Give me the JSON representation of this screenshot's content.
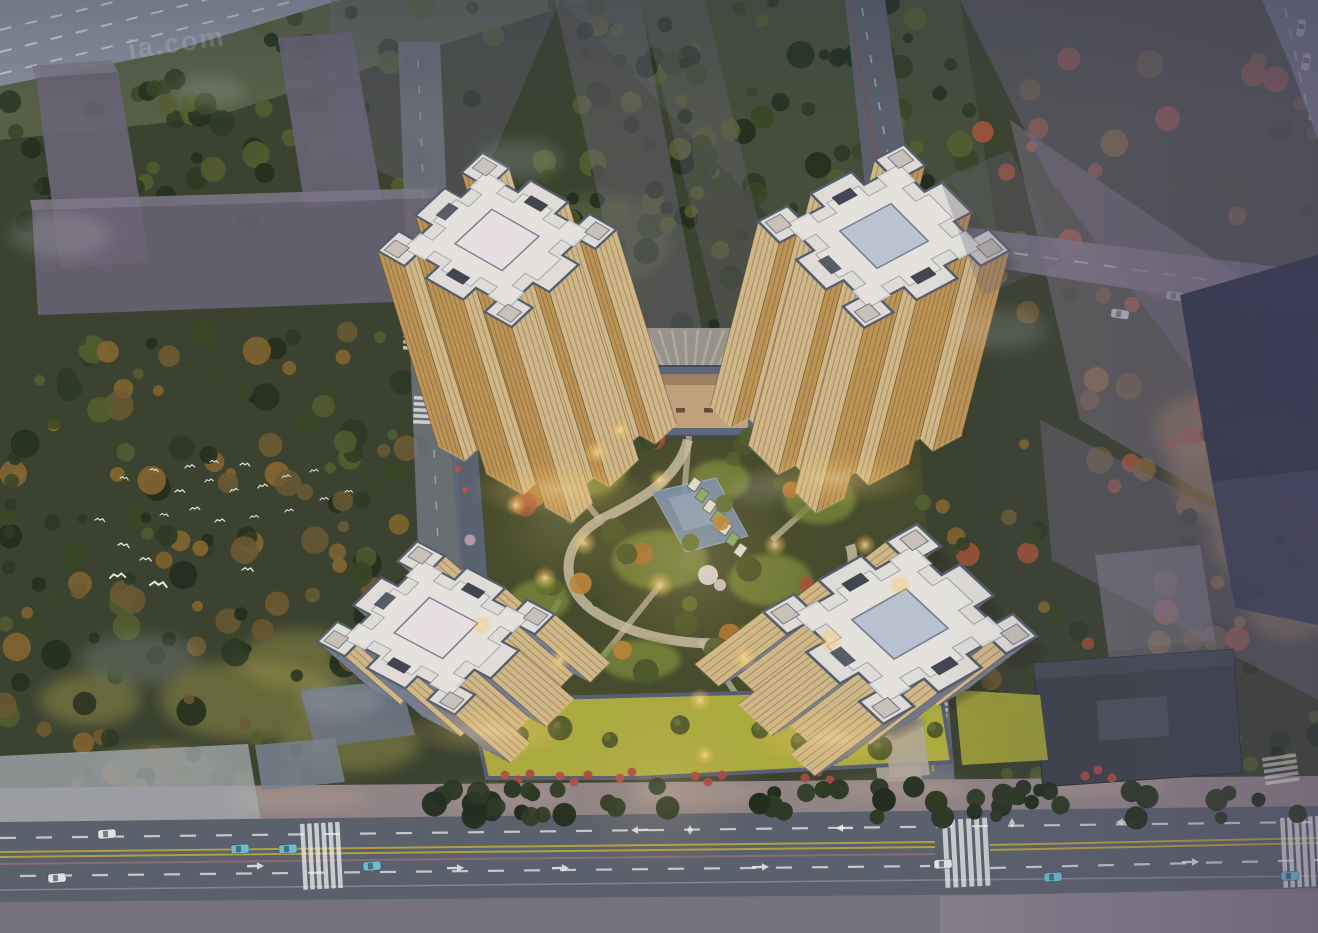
{
  "meta": {
    "type": "architectural-aerial-rendering",
    "time_of_day": "dusk",
    "subject": "four cruciform residential towers around a lit central courtyard garden, surrounded by ghosted grey city massing, tree belts and roads"
  },
  "watermark": {
    "text": "ia.com"
  },
  "scene": {
    "features": [
      "tower-northwest",
      "tower-northeast",
      "tower-southwest",
      "tower-southeast",
      "central-courtyard-garden",
      "north-entrance-gate",
      "entrance-plaza-fan",
      "pool",
      "market-stall-row",
      "perimeter-lawn",
      "roof-garden-strip",
      "red-sidewalk-trees",
      "street-tree-row",
      "main-road-south",
      "side-road-east",
      "side-road-west",
      "road-top-left",
      "road-top-right",
      "ghost-massing-blocks",
      "dark-office-slab",
      "bird-flock",
      "crosswalks",
      "cars",
      "path-lights"
    ],
    "colors": {
      "ground_base": "#3d4430",
      "grass_top": "#5d684a",
      "tree_dark1": "#232f1d",
      "tree_dark2": "#2e3b23",
      "tree_dark3": "#3a4827",
      "tree_olive": "#56602f",
      "tree_brown": "#6f5d33",
      "tree_rust": "#8a6a30",
      "autumn1": "#b5742f",
      "autumn2": "#c28a3a",
      "autumn3": "#a85638",
      "red_tree": "#b9554c",
      "blossom_white": "#e7dbde",
      "blossom_pink": "#d4afba",
      "lawn_bright": "#b2b240",
      "lawn_mid": "#7e8c3a",
      "courtyard_dark": "#474d2c",
      "path_light": "#cfc3a8",
      "plaza_light": "#a9a29a",
      "pool_blue": "#7e95b4",
      "gate_frame": "#5f6b80",
      "gate_warm": "#c9a87f",
      "wall_gray": "#5b6377",
      "roofgarden_gray": "#5e6a7c",
      "tower_roof": "#e9e6e0",
      "tower_roof_inner": "#f1eee8",
      "facade_warm_bright": "#d9bf8c",
      "facade_warm": "#c49a58",
      "facade_warm_mid": "#cdab6e",
      "facade_cool": "#a9b0bf",
      "facade_cool_dark": "#8f98aa",
      "ghost_purple": "#6e6878",
      "ghost_light": "#8b7f92",
      "dark_tower": "#30364a",
      "dark_slab": "#3f444b",
      "road_gray": "#5e6470",
      "road_light": "#8d97a4",
      "sidewalk_warm": "#96898b",
      "sidewalk_cool": "#7b7680",
      "pavement_light": "#a6abb0",
      "lane_yellow": "#c2ae3e",
      "car_white": "#e8eaec",
      "car_cyan": "#6fc4d8",
      "glow_warm": "#ffd98a",
      "bird_white": "#f2f0ea",
      "tan_ground": "#b08d4f"
    }
  }
}
